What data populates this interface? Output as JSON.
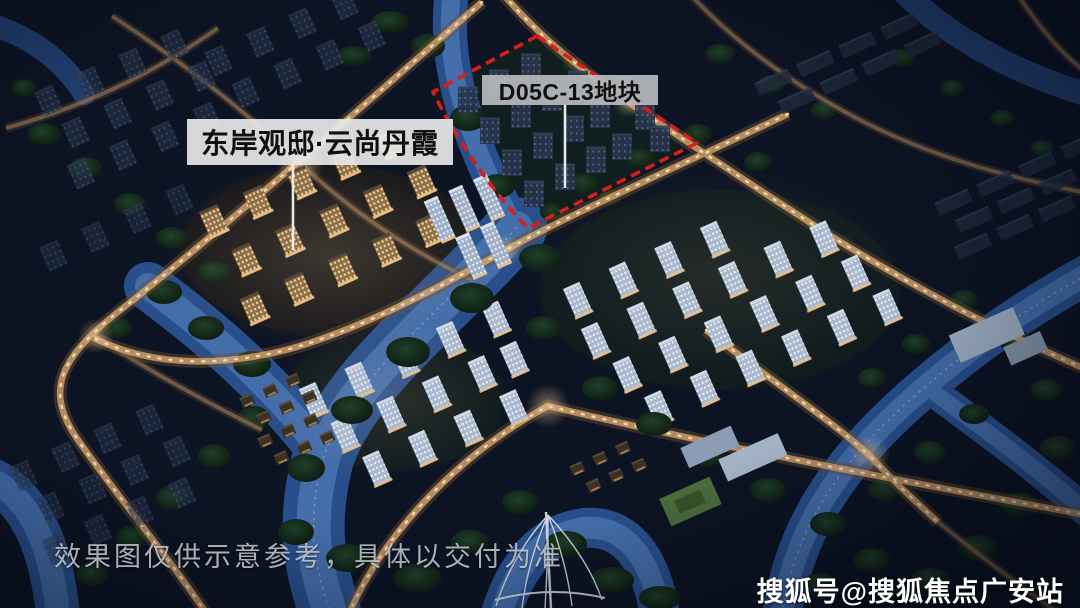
{
  "annotations": {
    "project_label": "东岸观邸·云尚丹霞",
    "plot_label": "D05C-13地块"
  },
  "footer": {
    "disclaimer": "效果图仅供示意参考，具体以交付为准",
    "watermark": "搜狐号@搜狐焦点广安站"
  },
  "colors": {
    "boundary_red": "#d91c1c",
    "label_bg": "rgba(232,232,232,0.92)",
    "plot_label_bg": "rgba(183,186,190,0.92)",
    "label_text": "#101010",
    "disclaimer_text": "rgba(206,211,217,0.82)",
    "watermark_text": "#ffffff",
    "water_blue": "#2c5697",
    "road_light_warm": "#e8b47a",
    "night_base": "#0c1322"
  }
}
